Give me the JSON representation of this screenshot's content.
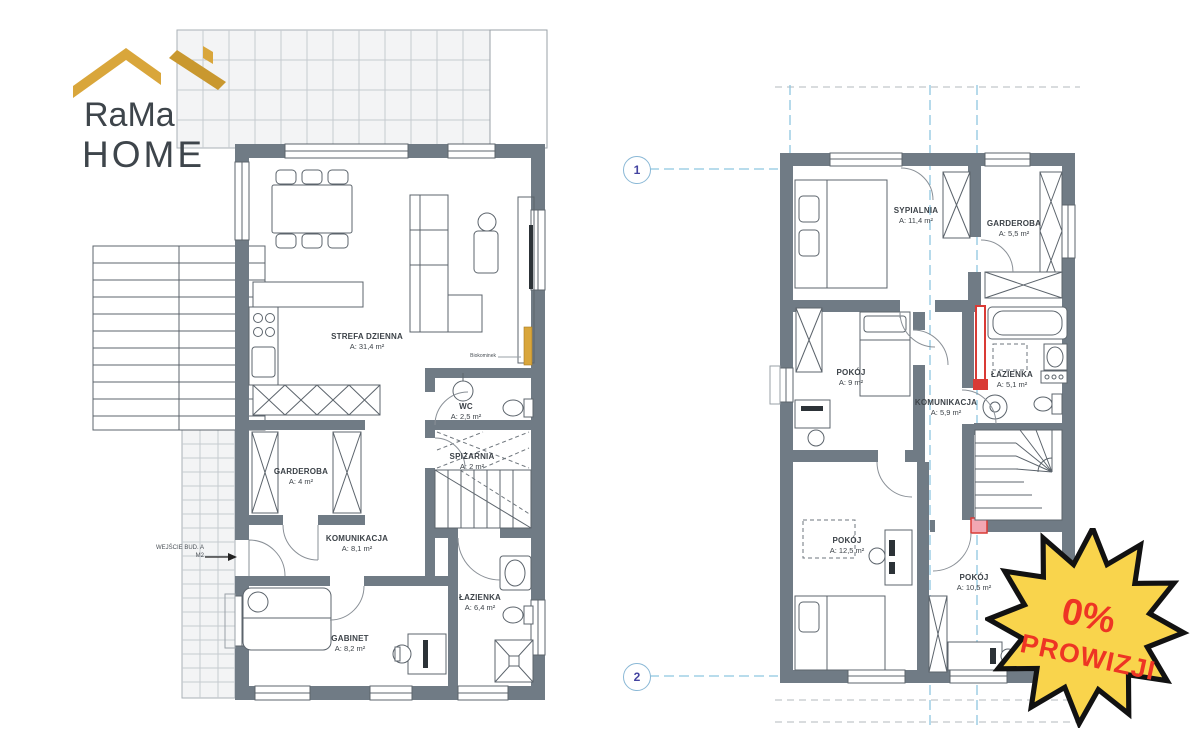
{
  "logo": {
    "line1": "RaMa",
    "line2": "HOME",
    "roof_color": "#D9A63B"
  },
  "badge": {
    "line1": "0%",
    "line2": "PROWIZJI",
    "fill": "#F9D44C",
    "stroke": "#121212",
    "text_color": "#EE3524"
  },
  "colors": {
    "wall": "#707B85",
    "section_line": "#8EC6E0",
    "radiator_red": "#D93A35",
    "marker_pink": "#F2A7B3"
  },
  "ground_floor": {
    "rooms": [
      {
        "name": "STREFA DZIENNA",
        "area": "A: 31,4 m²"
      },
      {
        "name": "WC",
        "area": "A: 2,5 m²"
      },
      {
        "name": "GARDEROBA",
        "area": "A: 4 m²"
      },
      {
        "name": "SPIŻARNIA",
        "area": "A: 2 m²"
      },
      {
        "name": "KOMUNIKACJA",
        "area": "A: 8,1 m²"
      },
      {
        "name": "ŁAZIENKA",
        "area": "A: 6,4 m²"
      },
      {
        "name": "GABINET",
        "area": "A: 8,2 m²"
      }
    ],
    "entrance_label": "WEJŚCIE BUD. A",
    "entrance_sublabel": "M2",
    "fireplace_label": "Biokominek"
  },
  "upper_floor": {
    "rooms": [
      {
        "name": "SYPIALNIA",
        "area": "A: 11,4 m²"
      },
      {
        "name": "GARDEROBA",
        "area": "A: 5,5 m²"
      },
      {
        "name": "POKÓJ",
        "area": "A: 9 m²"
      },
      {
        "name": "ŁAZIENKA",
        "area": "A: 5,1 m²"
      },
      {
        "name": "KOMUNIKACJA",
        "area": "A: 5,9 m²"
      },
      {
        "name": "POKÓJ",
        "area": "A: 12,5 m²"
      },
      {
        "name": "POKÓJ",
        "area": "A: 10,5 m²"
      }
    ],
    "axis_bubbles": [
      {
        "label": "1"
      },
      {
        "label": "2"
      }
    ]
  }
}
